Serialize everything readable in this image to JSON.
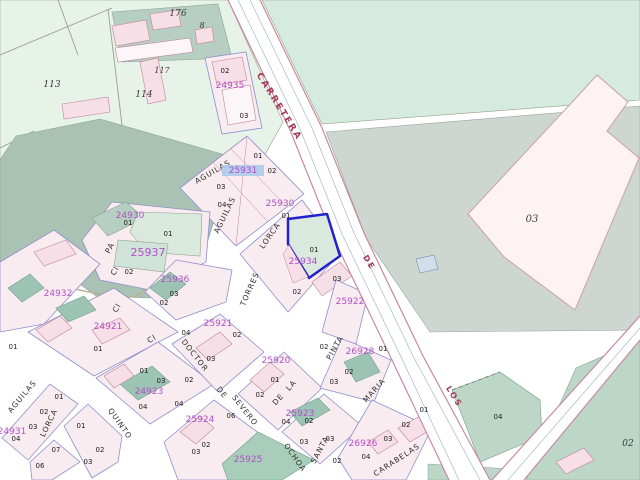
{
  "map": {
    "colors": {
      "magenta": "#b44fc8",
      "road-label": "#a43a55",
      "block-fill": "#f8ecf0",
      "block-stroke": "#8f8fca",
      "building-fill": "#f6dfe6",
      "building-stroke": "#bf8599",
      "teal-fill": "#9cc3b4",
      "selected-stroke": "#2222cc",
      "highlight-bg": "#a9c9ea",
      "pale-green": "#e7f2e9",
      "gray-green": "#a9c2b4",
      "topright-green": "#d6ebdf",
      "gray-parcel": "#cdd6cf",
      "bottomright-green": "#bcd7c8"
    },
    "road_labels": [
      {
        "t": "CARRETERA",
        "x": 277,
        "y": 108,
        "rot": 58,
        "size": 9,
        "ls": 2
      },
      {
        "t": "DE",
        "x": 367,
        "y": 264,
        "rot": 58,
        "size": 8
      },
      {
        "t": "LOS",
        "x": 452,
        "y": 398,
        "rot": 58,
        "size": 8
      }
    ],
    "street_labels": [
      {
        "t": "AGUILAS",
        "x": 214,
        "y": 174,
        "rot": -30
      },
      {
        "t": "AGUILAS",
        "x": 227,
        "y": 216,
        "rot": -64
      },
      {
        "t": "LORCA",
        "x": 272,
        "y": 237,
        "rot": -55
      },
      {
        "t": "TORRES",
        "x": 252,
        "y": 290,
        "rot": -66
      },
      {
        "t": "DOCTOR",
        "x": 193,
        "y": 357,
        "rot": 52
      },
      {
        "t": "DE",
        "x": 220,
        "y": 394,
        "rot": 52
      },
      {
        "t": "SEVERO",
        "x": 243,
        "y": 412,
        "rot": 52
      },
      {
        "t": "OCHOA",
        "x": 293,
        "y": 459,
        "rot": 55
      },
      {
        "t": "DE",
        "x": 280,
        "y": 401,
        "rot": -48
      },
      {
        "t": "LA",
        "x": 293,
        "y": 387,
        "rot": -48
      },
      {
        "t": "PINTA",
        "x": 337,
        "y": 349,
        "rot": -60
      },
      {
        "t": "SANTA",
        "x": 322,
        "y": 451,
        "rot": -62
      },
      {
        "t": "MARIA",
        "x": 376,
        "y": 392,
        "rot": -48
      },
      {
        "t": "QUINTO",
        "x": 118,
        "y": 425,
        "rot": 55
      },
      {
        "t": "LORCA",
        "x": 51,
        "y": 424,
        "rot": -64
      },
      {
        "t": "AGUILAS",
        "x": 24,
        "y": 398,
        "rot": -50
      },
      {
        "t": "CARABELAS",
        "x": 398,
        "y": 462,
        "rot": -33
      },
      {
        "t": "Cl",
        "x": 117,
        "y": 272,
        "rot": -60
      },
      {
        "t": "Cl",
        "x": 119,
        "y": 309,
        "rot": -60
      },
      {
        "t": "Cl",
        "x": 153,
        "y": 341,
        "rot": -30
      },
      {
        "t": "PA",
        "x": 112,
        "y": 249,
        "rot": -62
      }
    ],
    "parcel_ids": [
      {
        "t": "24935",
        "x": 230,
        "y": 88
      },
      {
        "t": "25931",
        "x": 243,
        "y": 173,
        "hl": true
      },
      {
        "t": "25930",
        "x": 280,
        "y": 206
      },
      {
        "t": "24930",
        "x": 130,
        "y": 218
      },
      {
        "t": "25937",
        "x": 148,
        "y": 256,
        "size": 11
      },
      {
        "t": "25936",
        "x": 175,
        "y": 282
      },
      {
        "t": "25934",
        "x": 303,
        "y": 264
      },
      {
        "t": "24932",
        "x": 58,
        "y": 296
      },
      {
        "t": "24921",
        "x": 108,
        "y": 329
      },
      {
        "t": "24923",
        "x": 149,
        "y": 394
      },
      {
        "t": "24931",
        "x": 12,
        "y": 434
      },
      {
        "t": "25921",
        "x": 218,
        "y": 326
      },
      {
        "t": "25922",
        "x": 350,
        "y": 304
      },
      {
        "t": "25920",
        "x": 276,
        "y": 363
      },
      {
        "t": "25923",
        "x": 300,
        "y": 416
      },
      {
        "t": "25924",
        "x": 200,
        "y": 422
      },
      {
        "t": "25925",
        "x": 248,
        "y": 462
      },
      {
        "t": "26928",
        "x": 360,
        "y": 354
      },
      {
        "t": "26926",
        "x": 363,
        "y": 446
      }
    ],
    "cell_numbers": [
      {
        "t": "02",
        "x": 225,
        "y": 73
      },
      {
        "t": "03",
        "x": 244,
        "y": 118
      },
      {
        "t": "01",
        "x": 258,
        "y": 158
      },
      {
        "t": "02",
        "x": 272,
        "y": 173
      },
      {
        "t": "03",
        "x": 221,
        "y": 189
      },
      {
        "t": "04",
        "x": 222,
        "y": 207
      },
      {
        "t": "01",
        "x": 286,
        "y": 218
      },
      {
        "t": "01",
        "x": 314,
        "y": 252
      },
      {
        "t": "02",
        "x": 297,
        "y": 294
      },
      {
        "t": "03",
        "x": 337,
        "y": 281
      },
      {
        "t": "01",
        "x": 128,
        "y": 225
      },
      {
        "t": "01",
        "x": 168,
        "y": 236
      },
      {
        "t": "02",
        "x": 129,
        "y": 274
      },
      {
        "t": "03",
        "x": 174,
        "y": 296
      },
      {
        "t": "02",
        "x": 164,
        "y": 305
      },
      {
        "t": "01",
        "x": 98,
        "y": 351
      },
      {
        "t": "01",
        "x": 13,
        "y": 349
      },
      {
        "t": "01",
        "x": 144,
        "y": 373
      },
      {
        "t": "03",
        "x": 161,
        "y": 383
      },
      {
        "t": "02",
        "x": 189,
        "y": 382
      },
      {
        "t": "04",
        "x": 186,
        "y": 335
      },
      {
        "t": "02",
        "x": 237,
        "y": 337
      },
      {
        "t": "03",
        "x": 211,
        "y": 361
      },
      {
        "t": "01",
        "x": 275,
        "y": 382
      },
      {
        "t": "02",
        "x": 260,
        "y": 397
      },
      {
        "t": "04",
        "x": 286,
        "y": 424
      },
      {
        "t": "02",
        "x": 309,
        "y": 423
      },
      {
        "t": "03",
        "x": 304,
        "y": 444
      },
      {
        "t": "03",
        "x": 330,
        "y": 441
      },
      {
        "t": "06",
        "x": 231,
        "y": 418
      },
      {
        "t": "03",
        "x": 196,
        "y": 454
      },
      {
        "t": "02",
        "x": 206,
        "y": 447
      },
      {
        "t": "01",
        "x": 59,
        "y": 399
      },
      {
        "t": "02",
        "x": 44,
        "y": 414
      },
      {
        "t": "03",
        "x": 33,
        "y": 429
      },
      {
        "t": "04",
        "x": 16,
        "y": 441
      },
      {
        "t": "07",
        "x": 56,
        "y": 452
      },
      {
        "t": "06",
        "x": 40,
        "y": 468
      },
      {
        "t": "01",
        "x": 81,
        "y": 428
      },
      {
        "t": "02",
        "x": 100,
        "y": 452
      },
      {
        "t": "03",
        "x": 88,
        "y": 464
      },
      {
        "t": "04",
        "x": 143,
        "y": 409
      },
      {
        "t": "04",
        "x": 179,
        "y": 406
      },
      {
        "t": "01",
        "x": 383,
        "y": 351
      },
      {
        "t": "02",
        "x": 349,
        "y": 374
      },
      {
        "t": "03",
        "x": 334,
        "y": 384
      },
      {
        "t": "02",
        "x": 324,
        "y": 349
      },
      {
        "t": "01",
        "x": 424,
        "y": 412
      },
      {
        "t": "02",
        "x": 406,
        "y": 427
      },
      {
        "t": "03",
        "x": 388,
        "y": 441
      },
      {
        "t": "04",
        "x": 366,
        "y": 459
      },
      {
        "t": "02",
        "x": 337,
        "y": 463
      },
      {
        "t": "04",
        "x": 498,
        "y": 419
      }
    ],
    "area_numbers": [
      {
        "t": "176",
        "x": 178,
        "y": 16
      },
      {
        "t": "8",
        "x": 202,
        "y": 28,
        "size": 8
      },
      {
        "t": "113",
        "x": 52,
        "y": 87
      },
      {
        "t": "114",
        "x": 144,
        "y": 97
      },
      {
        "t": "117",
        "x": 162,
        "y": 73,
        "size": 8
      },
      {
        "t": "03",
        "x": 532,
        "y": 222,
        "size": 10
      },
      {
        "t": "02",
        "x": 628,
        "y": 446
      }
    ]
  }
}
